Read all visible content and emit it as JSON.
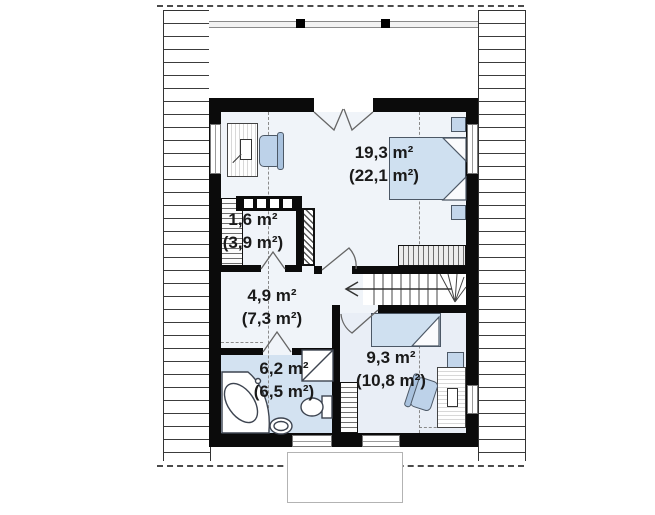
{
  "plan": {
    "type": "attic floor plan",
    "rooms": [
      {
        "name": "bedroom-large",
        "area": "19,3 m²",
        "total": "(22,1 m²)"
      },
      {
        "name": "storage",
        "area": "1,6 m²",
        "total": "(3,9 m²)"
      },
      {
        "name": "hall",
        "area": "4,9 m²",
        "total": "(7,3 m²)"
      },
      {
        "name": "bathroom",
        "area": "6,2 m²",
        "total": "(6,5 m²)"
      },
      {
        "name": "bedroom-small",
        "area": "9,3 m²",
        "total": "(10,8 m²)"
      }
    ],
    "colors": {
      "wall": "#0b0b0b",
      "floor": "#f0f4f9",
      "bathroom_floor": "#d3e2f1",
      "bedroom_small_floor": "#e9eef6",
      "furniture_blue": "#c3d6eb",
      "bed_blue": "#cfe0f0",
      "label_text": "#1a1a1a"
    }
  }
}
